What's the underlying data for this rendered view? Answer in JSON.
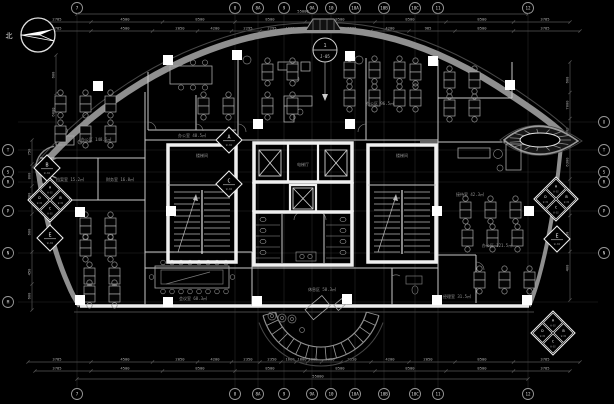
{
  "colors": {
    "bg": "#000000",
    "grid": "#2b2b2b",
    "dim_line": "#555555",
    "dim_text": "#b0b0b0",
    "bubble": "#9a9a9a",
    "bubble_text": "#dcdcdc",
    "wall_outer": "#8f8f8f",
    "wall_core": "#f0f0f0",
    "partition": "#c8c8c8",
    "furniture": "#a8a8a8",
    "label": "#949494",
    "marker": "#ececec",
    "column": "#ffffff",
    "accent_thin": "#474747"
  },
  "north": {
    "label": "北"
  },
  "detail_callout": {
    "top": "1",
    "bottom": "J-05"
  },
  "grid": {
    "verticals": [
      {
        "x": 77,
        "label": "7"
      },
      {
        "x": 235,
        "label": "8"
      },
      {
        "x": 258,
        "label": "8A"
      },
      {
        "x": 284,
        "label": "9"
      },
      {
        "x": 312,
        "label": "9A"
      },
      {
        "x": 331,
        "label": "10"
      },
      {
        "x": 355,
        "label": "10A"
      },
      {
        "x": 384,
        "label": "10B"
      },
      {
        "x": 415,
        "label": "10C"
      },
      {
        "x": 438,
        "label": "11"
      },
      {
        "x": 528,
        "label": "12"
      }
    ],
    "horizontals": [
      {
        "y": 122,
        "label": "U",
        "sides": "r"
      },
      {
        "y": 150,
        "label": "T",
        "sides": "lr"
      },
      {
        "y": 172,
        "label": "S",
        "sides": "lr"
      },
      {
        "y": 182,
        "label": "R",
        "sides": "lr"
      },
      {
        "y": 211,
        "label": "P",
        "sides": "lr"
      },
      {
        "y": 253,
        "label": "N",
        "sides": "lr"
      },
      {
        "y": 302,
        "label": "M",
        "sides": "l"
      }
    ]
  },
  "dimensions": {
    "top_total": {
      "y": 14,
      "x1": 77,
      "x2": 528,
      "items": [
        {
          "t": "55000",
          "x": 303
        }
      ]
    },
    "top_main": {
      "y": 22,
      "x1": 35,
      "x2": 570,
      "items": [
        {
          "t": "2785",
          "x": 57
        },
        {
          "t": "4500",
          "x": 125
        },
        {
          "t": "8500",
          "x": 200
        },
        {
          "t": "8500",
          "x": 270
        },
        {
          "t": "8500",
          "x": 340
        },
        {
          "t": "8500",
          "x": 410
        },
        {
          "t": "8500",
          "x": 482
        },
        {
          "t": "3785",
          "x": 545
        }
      ]
    },
    "top_fine": {
      "y": 31,
      "x1": 28,
      "x2": 580,
      "items": [
        {
          "t": "3785",
          "x": 57
        },
        {
          "t": "4500",
          "x": 125
        },
        {
          "t": "2050",
          "x": 180
        },
        {
          "t": "4200",
          "x": 215
        },
        {
          "t": "2295",
          "x": 248
        },
        {
          "t": "2295",
          "x": 272
        },
        {
          "t": "1600",
          "x": 290
        },
        {
          "t": "1900",
          "x": 302
        },
        {
          "t": "1500",
          "x": 313
        },
        {
          "t": "2295",
          "x": 330
        },
        {
          "t": "2295",
          "x": 352
        },
        {
          "t": "4200",
          "x": 390
        },
        {
          "t": "985",
          "x": 428
        },
        {
          "t": "8500",
          "x": 482
        },
        {
          "t": "3785",
          "x": 545
        }
      ]
    },
    "bottom_fine": {
      "y": 362,
      "x1": 28,
      "x2": 580,
      "items": [
        {
          "t": "3785",
          "x": 57
        },
        {
          "t": "4500",
          "x": 125
        },
        {
          "t": "2050",
          "x": 180
        },
        {
          "t": "4200",
          "x": 215
        },
        {
          "t": "2350",
          "x": 248
        },
        {
          "t": "2350",
          "x": 272
        },
        {
          "t": "1600",
          "x": 290
        },
        {
          "t": "1800",
          "x": 302
        },
        {
          "t": "1000",
          "x": 313
        },
        {
          "t": "2350",
          "x": 330
        },
        {
          "t": "2350",
          "x": 352
        },
        {
          "t": "4200",
          "x": 390
        },
        {
          "t": "2050",
          "x": 428
        },
        {
          "t": "8500",
          "x": 482
        },
        {
          "t": "3785",
          "x": 545
        }
      ]
    },
    "bottom_main": {
      "y": 371,
      "x1": 35,
      "x2": 570,
      "items": [
        {
          "t": "3785",
          "x": 57
        },
        {
          "t": "4500",
          "x": 125
        },
        {
          "t": "8500",
          "x": 200
        },
        {
          "t": "8500",
          "x": 270
        },
        {
          "t": "8500",
          "x": 340
        },
        {
          "t": "8500",
          "x": 410
        },
        {
          "t": "8500",
          "x": 482
        },
        {
          "t": "3785",
          "x": 545
        }
      ]
    },
    "bottom_total": {
      "y": 379,
      "x1": 77,
      "x2": 528,
      "items": [
        {
          "t": "55000",
          "x": 318
        }
      ]
    },
    "left_upper": {
      "x": 56,
      "y1": 55,
      "y2": 150,
      "items": [
        {
          "t": "600",
          "y": 75
        },
        {
          "t": "6000",
          "y": 112
        }
      ]
    },
    "left_lower": {
      "x": 32,
      "y1": 140,
      "y2": 310,
      "items": [
        {
          "t": "750",
          "y": 152
        },
        {
          "t": "800",
          "y": 176
        },
        {
          "t": "780",
          "y": 196
        },
        {
          "t": "600",
          "y": 232
        },
        {
          "t": "450",
          "y": 272
        },
        {
          "t": "600",
          "y": 296
        }
      ]
    },
    "right_outer": {
      "x": 570,
      "y1": 62,
      "y2": 300,
      "items": [
        {
          "t": "600",
          "y": 80
        },
        {
          "t": "7000",
          "y": 105
        },
        {
          "t": "2700",
          "y": 132
        },
        {
          "t": "6300",
          "y": 162
        },
        {
          "t": "800",
          "y": 196
        },
        {
          "t": "450",
          "y": 235
        },
        {
          "t": "400",
          "y": 268
        }
      ]
    }
  },
  "columns": [
    [
      98,
      86
    ],
    [
      168,
      60
    ],
    [
      237,
      55
    ],
    [
      350,
      56
    ],
    [
      433,
      61
    ],
    [
      510,
      85
    ],
    [
      258,
      124
    ],
    [
      350,
      124
    ],
    [
      80,
      212
    ],
    [
      171,
      211
    ],
    [
      437,
      211
    ],
    [
      529,
      211
    ],
    [
      80,
      300
    ],
    [
      168,
      302
    ],
    [
      257,
      301
    ],
    [
      347,
      299
    ],
    [
      437,
      300
    ],
    [
      527,
      300
    ]
  ],
  "rooms": [
    {
      "label": "办公区 148.6㎡",
      "x": 96,
      "y": 141
    },
    {
      "label": "办公室 48.5㎡",
      "x": 192,
      "y": 137
    },
    {
      "label": "档案室 15.2㎡",
      "x": 70,
      "y": 181
    },
    {
      "label": "财务室 16.8㎡",
      "x": 120,
      "y": 181
    },
    {
      "label": "会议室 68.3㎡",
      "x": 193,
      "y": 300
    },
    {
      "label": "休息区 58.3㎡",
      "x": 322,
      "y": 291
    },
    {
      "label": "电梯厅",
      "x": 303,
      "y": 166
    },
    {
      "label": "楼梯间",
      "x": 202,
      "y": 157
    },
    {
      "label": "楼梯间",
      "x": 402,
      "y": 157
    },
    {
      "label": "办公区 96.5㎡",
      "x": 380,
      "y": 105
    },
    {
      "label": "办公区 121.5㎡",
      "x": 497,
      "y": 247
    },
    {
      "label": "接待室 42.3㎡",
      "x": 470,
      "y": 196
    },
    {
      "label": "经理室 31.5㎡",
      "x": 457,
      "y": 298
    }
  ],
  "markers": {
    "ref": "W-02",
    "singles": [
      {
        "x": 229,
        "y": 140,
        "letter": "A"
      },
      {
        "x": 229,
        "y": 184,
        "letter": "C"
      },
      {
        "x": 47,
        "y": 168,
        "letter": "B"
      },
      {
        "x": 50,
        "y": 238,
        "letter": "E"
      },
      {
        "x": 557,
        "y": 239,
        "letter": "E"
      }
    ],
    "quads": [
      {
        "x": 50,
        "y": 200
      },
      {
        "x": 556,
        "y": 199
      },
      {
        "x": 553,
        "y": 333
      }
    ],
    "quad_letters": [
      "A",
      "B",
      "C",
      "D"
    ]
  }
}
